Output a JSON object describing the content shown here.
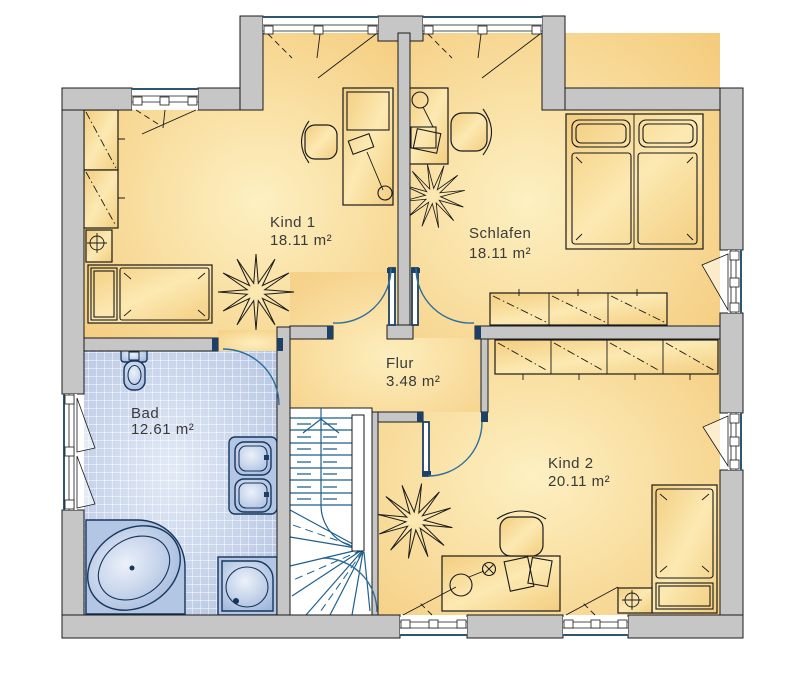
{
  "rooms": {
    "kind1": {
      "name": "Kind 1",
      "area": "18.11 m²"
    },
    "schlafen": {
      "name": "Schlafen",
      "area": "18.11 m²"
    },
    "flur": {
      "name": "Flur",
      "area": "3.48 m²"
    },
    "bad": {
      "name": "Bad",
      "area": "12.61 m²"
    },
    "kind2": {
      "name": "Kind 2",
      "area": "20.11 m²"
    }
  },
  "symbols": {
    "plant-icon": "starburst",
    "radiator-icon": "circle-cross",
    "lamp-icon": "circle-x",
    "stairs-up-arrow-icon": "triangle-up"
  },
  "colors": {
    "wall-fill": "#c6c6c6",
    "line": "#1a1a1a",
    "room-center": "#fdf0c2",
    "room-edge": "#f4cb7c",
    "furniture-light": "#fce9b2",
    "furniture-deep": "#f3cd7f",
    "bath-tile-light": "#e2eaf6",
    "bath-tile-deep": "#b3c3e1",
    "fixture-light": "#ecf1fa",
    "fixture-deep": "#9db4da",
    "fixture-outline": "#16365c",
    "stair-line": "#1e5f8e",
    "door-arc": "#2d6f9c",
    "door-jamb": "#1d4066",
    "window-outer": "#2e566e",
    "label-text": "#3a3a3a"
  }
}
